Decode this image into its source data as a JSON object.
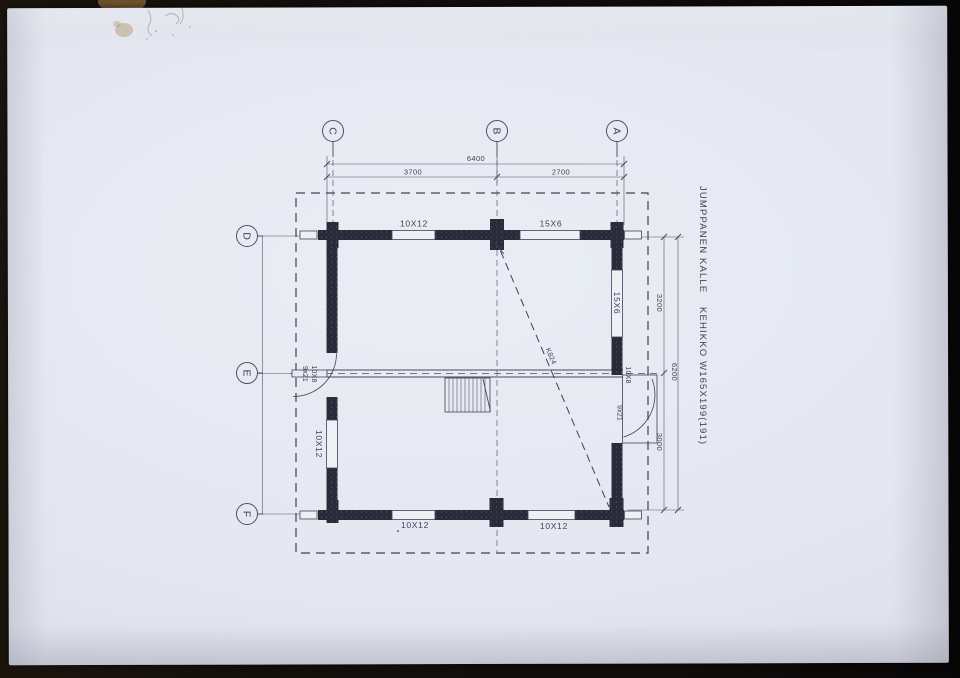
{
  "drawing": {
    "title_1": "JUMPPANEN KALLE",
    "title_2": "KEHIKKO W165X199(191)",
    "grid_top": [
      "C",
      "B",
      "A"
    ],
    "grid_left": [
      "D",
      "E",
      "F"
    ],
    "dims": {
      "top_total": "6400",
      "top_seg1": "3700",
      "top_seg2": "2700",
      "right_seg1": "3200",
      "right_seg2": "3000",
      "right_total": "6200"
    },
    "openings": {
      "top1": "10X12",
      "top2": "15X6",
      "left": "10X12",
      "right": "15X6",
      "bottom1": "10X12",
      "bottom2": "10X12",
      "door_left_a": "9x21",
      "door_left_b": "10X8",
      "door_right_a": "10X8",
      "door_right_b": "9x21",
      "diagonal": "K824"
    }
  },
  "colors": {
    "paper": "#e6e9f1",
    "ink": "#3e4357",
    "wall": "#272b39",
    "photo_edge": "#141109"
  }
}
